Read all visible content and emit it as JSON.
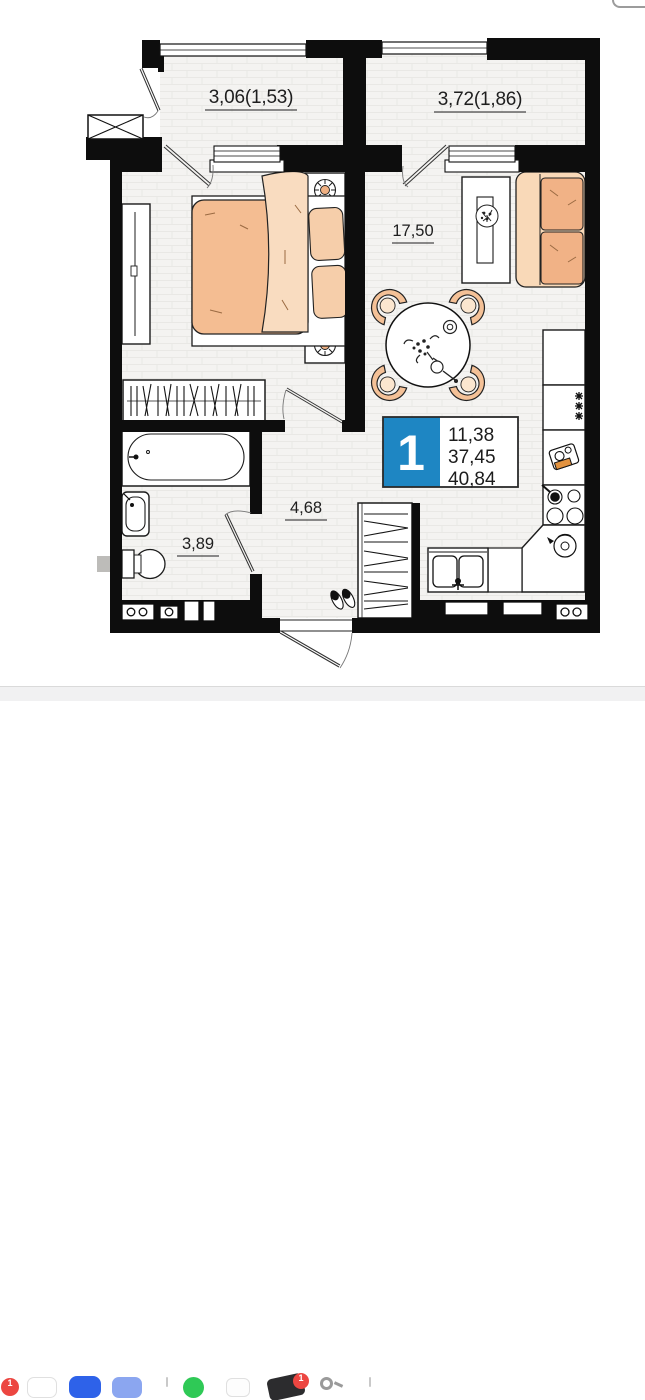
{
  "plan": {
    "labels": {
      "balcony_left": "3,06(1,53)",
      "balcony_right": "3,72(1,86)",
      "living_kitchen": "17,50",
      "bathroom": "3,89",
      "hallway": "4,68"
    },
    "unit_badge": {
      "rooms": "1",
      "living_area": "11,38",
      "apartment_area": "37,45",
      "total_area": "40,84",
      "accent_color": "#1e86c3"
    },
    "colors": {
      "walls": "#0d0d0d",
      "floor": "#f4f3f1",
      "floor_line": "#e9e8e5",
      "furniture_peach": "#f4bd92",
      "furniture_peach_light": "#f9dcc0",
      "outline": "#1c1c1c"
    }
  },
  "dock": {
    "badge_left": "1",
    "badge_messages": "1",
    "items": [
      {
        "name": "notification-badge-red",
        "color": "#ec4641"
      },
      {
        "name": "app-white-1",
        "color": "#ffffff"
      },
      {
        "name": "app-blue",
        "color": "#2e62e9"
      },
      {
        "name": "app-light-blue",
        "color": "#8ba6f0"
      },
      {
        "name": "separator",
        "color": "#c9c9c9"
      },
      {
        "name": "app-green",
        "color": "#2fc956"
      },
      {
        "name": "app-white-2",
        "color": "#fdfdfd"
      },
      {
        "name": "app-dark-with-badge",
        "color": "#2c2c2e"
      },
      {
        "name": "keychain-icon",
        "color": "#9b9b9b"
      },
      {
        "name": "separator",
        "color": "#c9c9c9"
      }
    ]
  }
}
